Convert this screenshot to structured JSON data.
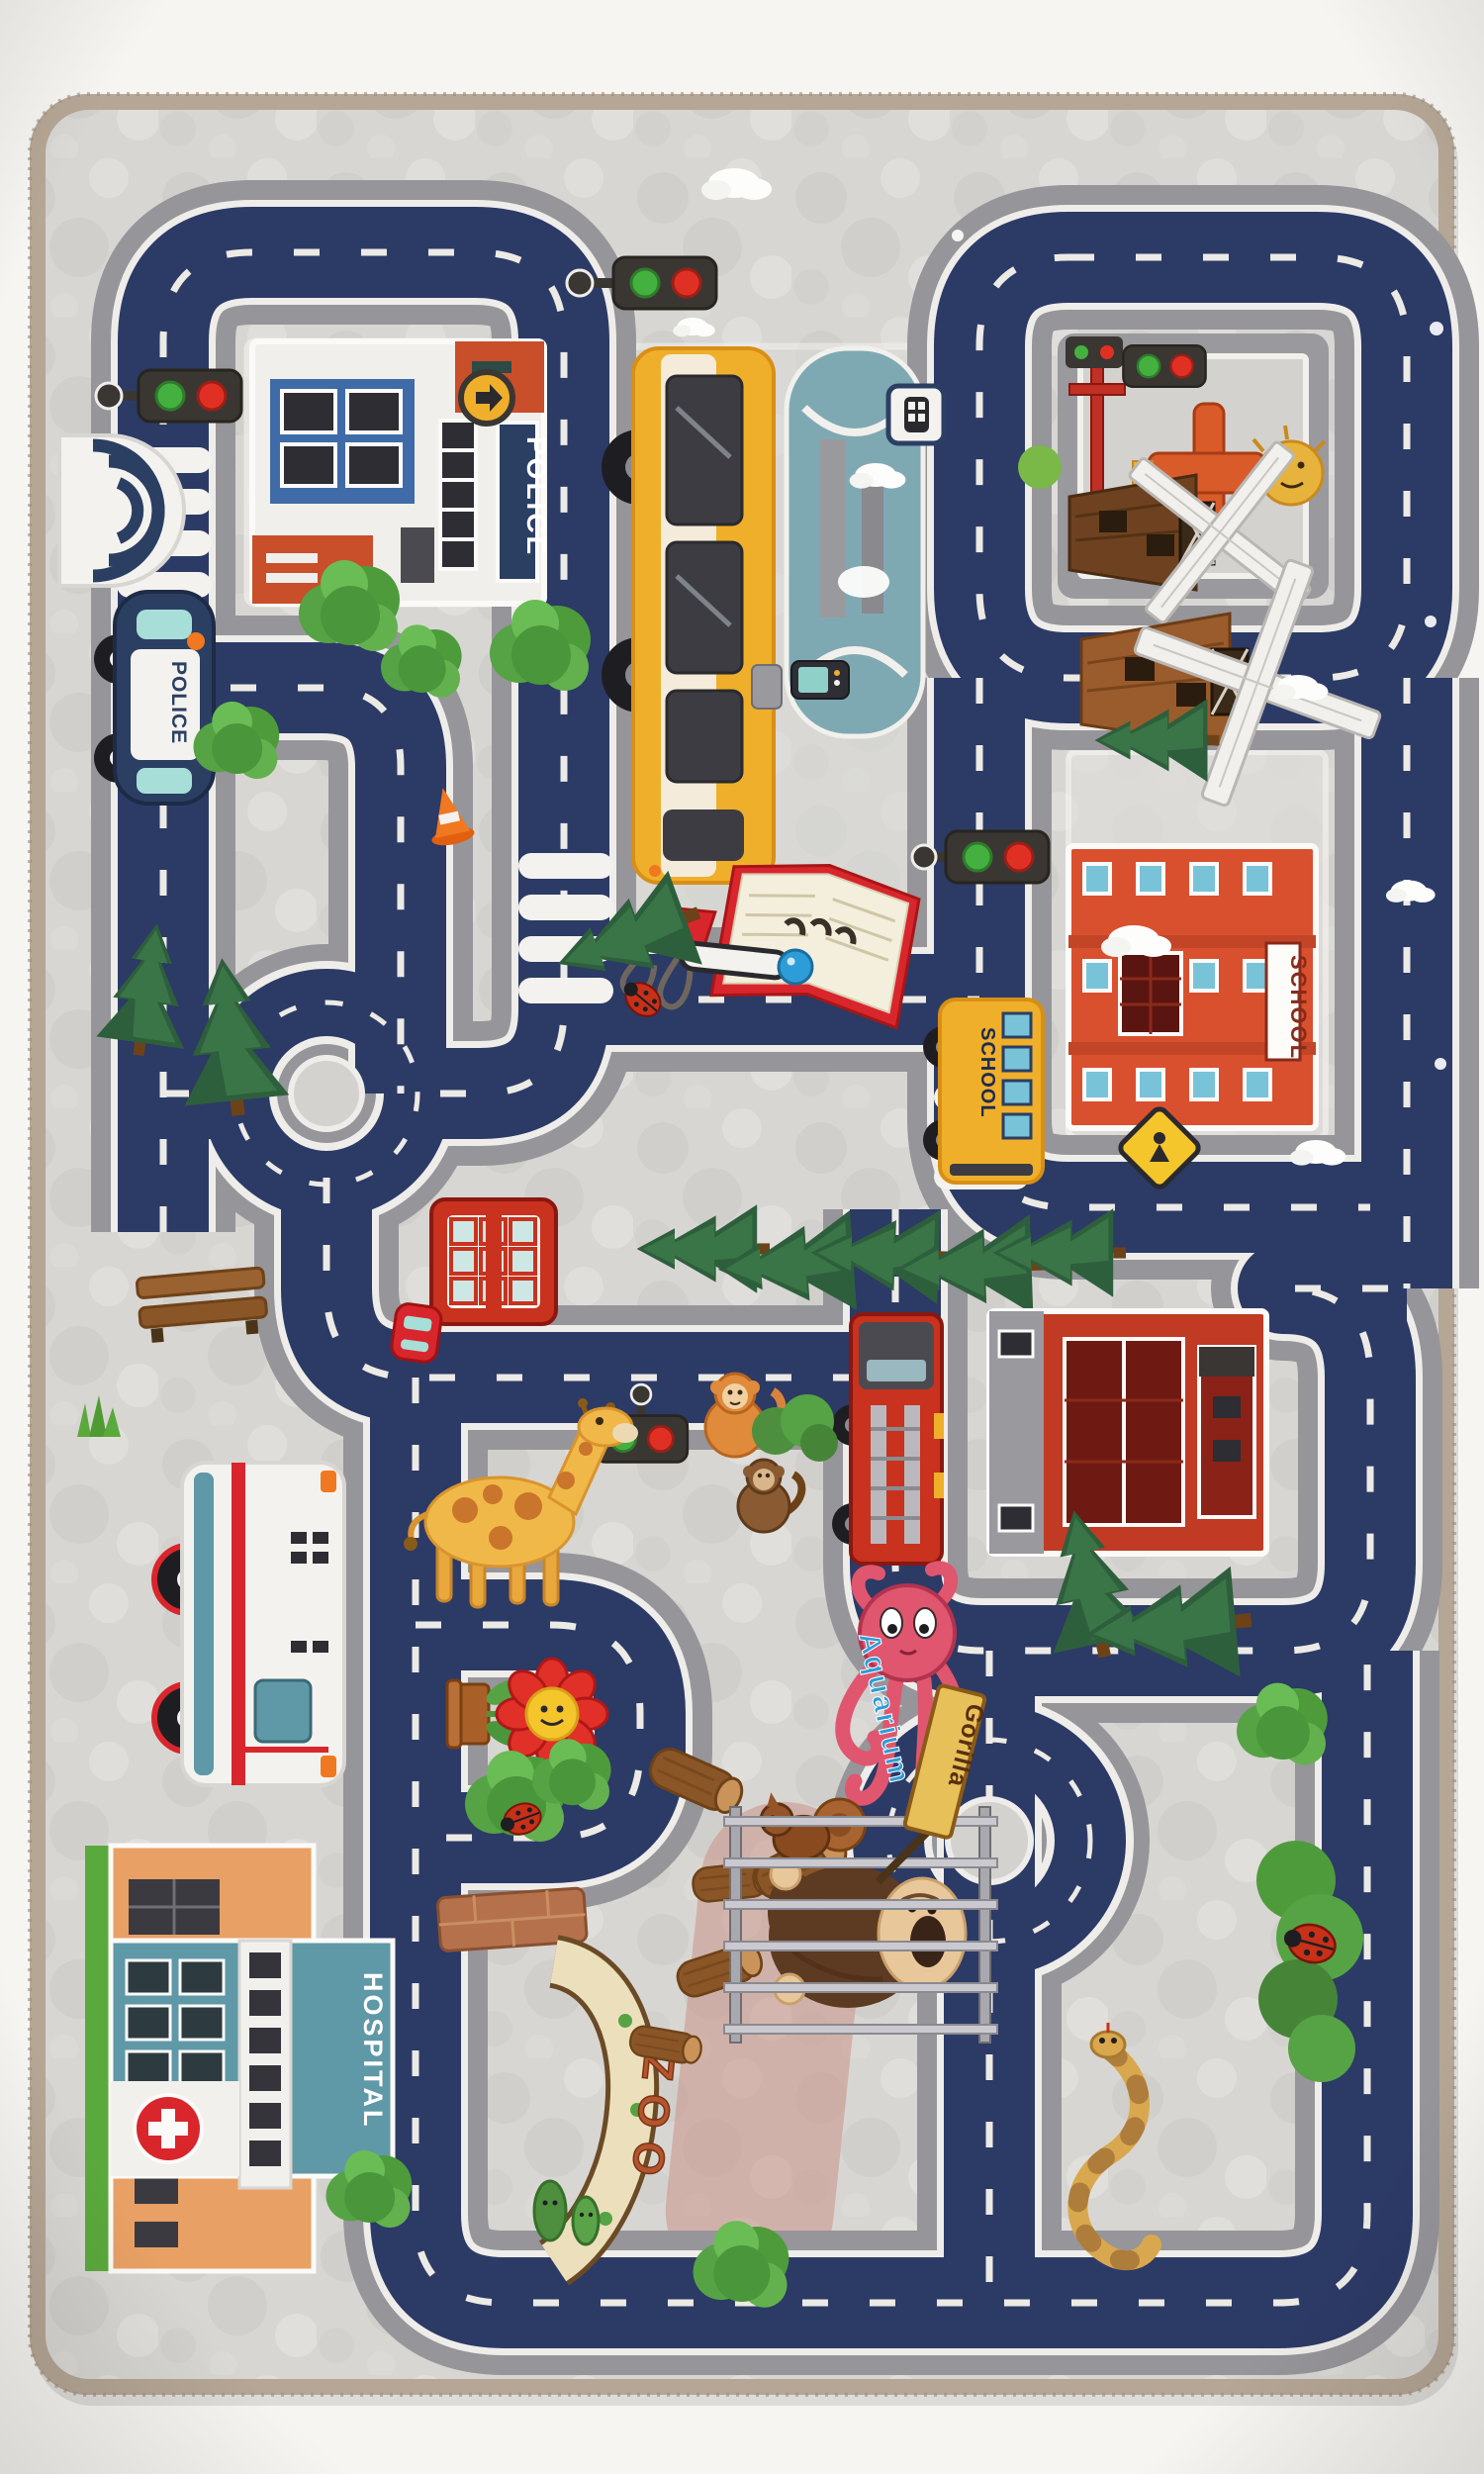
{
  "scene": {
    "description": "Photograph of a children's city-road play rug on a white backdrop",
    "rug_type": "kids road play mat with navy roads, gray ground, buildings and animals"
  },
  "labels": {
    "police_station_sign": "POLICE",
    "police_car_text": "POLICE",
    "school_building_sign": "SCHOOL",
    "school_bus_text": "SCHOOL",
    "hospital_sign": "HOSPITAL",
    "zoo_entrance_sign": "ZOO",
    "gorilla_cage_sign": "Gorilla",
    "aquarium_octopus_sign": "Aquarium"
  },
  "colors": {
    "backdrop_white": "#f6f5f2",
    "rug_binding_tan": "#b5a695",
    "ground_gray": "#d7d5d2",
    "road_navy": "#2c3a66",
    "curb_gray": "#96959a",
    "dash_white": "#eceae5",
    "red_accent": "#c8321e",
    "school_orange_red": "#d9502f",
    "hospital_teal": "#5f98a6",
    "bus_yellow": "#f0af2a",
    "grass_green": "#5aa93c",
    "traffic_green": "#43b03f",
    "traffic_red": "#e03024"
  },
  "objects": [
    "police station",
    "police car",
    "traffic lights",
    "zebra crossings",
    "city bus",
    "fountain",
    "mobile phone",
    "bus stop sign",
    "arrow sign",
    "farm windmills",
    "scarecrow",
    "railroad signal",
    "school building",
    "school bus",
    "school crossing sign",
    "open book",
    "binder clip",
    "pen",
    "ladybugs",
    "pine trees",
    "round trees",
    "roundabouts",
    "phone booth",
    "toy car",
    "bench",
    "traffic cone",
    "fire station",
    "fire truck",
    "giraffe",
    "monkeys",
    "octopus",
    "zoo entrance arch",
    "brick wall",
    "logs",
    "squirrel",
    "gorilla in cage",
    "snake",
    "ambulance",
    "hospital",
    "smiling flower in pot",
    "clouds",
    "bushes",
    "cactus"
  ]
}
